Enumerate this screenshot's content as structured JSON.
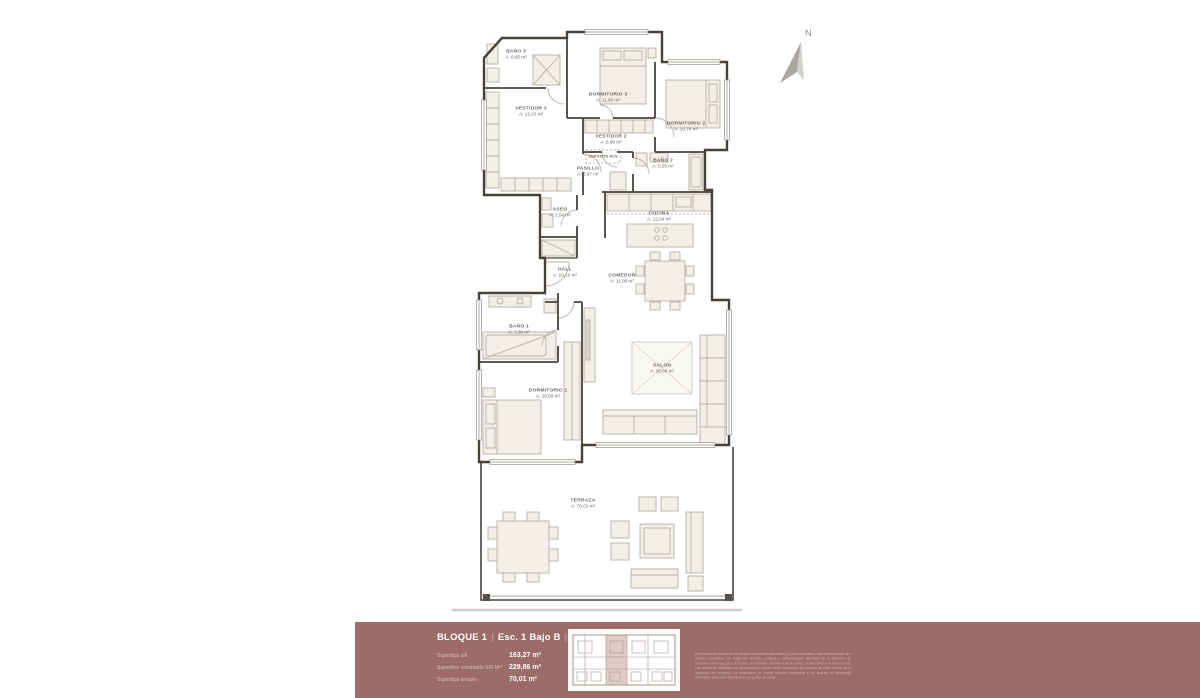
{
  "plan": {
    "north_label": "N",
    "rooms": [
      {
        "name": "BAÑO 3",
        "area": "A: 6,65 m²"
      },
      {
        "name": "DORMITORIO 3",
        "area": "A: 11,66 m²"
      },
      {
        "name": "VESTIDOR 3",
        "area": "A: 13,20 m²"
      },
      {
        "name": "DORMITORIO 2",
        "area": "A: 10,70 m²"
      },
      {
        "name": "VESTIDOR 2",
        "area": "A: 6,49 m²"
      },
      {
        "name": "DEPOSITO ACS",
        "area": ""
      },
      {
        "name": "PASILLO",
        "area": "A: 2,87 m²"
      },
      {
        "name": "BAÑO 2",
        "area": "A: 5,55 m²"
      },
      {
        "name": "ASEO",
        "area": "A: 2,54 m²"
      },
      {
        "name": "COCINA",
        "area": "A: 12,24 m²"
      },
      {
        "name": "HALL",
        "area": "A: 10,10 m²"
      },
      {
        "name": "COMEDOR",
        "area": "A: 11,09 m²"
      },
      {
        "name": "BAÑO 1",
        "area": "A: 7,39 m²"
      },
      {
        "name": "DORMITORIO 1",
        "area": "A: 20,58 m²"
      },
      {
        "name": "SALON",
        "area": "A: 38,68 m²"
      },
      {
        "name": "TERRAZA",
        "area": "A: 70,01 m²"
      }
    ]
  },
  "footer": {
    "block": "BLOQUE 1",
    "unit": "Esc. 1 Bajo B",
    "scale": "escala 1:75",
    "separator": "|",
    "specs": [
      {
        "label": "Superficie útil",
        "value": "163,27 m²"
      },
      {
        "label": "Superficie construida S/R M²*",
        "value": "229,86 m²"
      },
      {
        "label": "Superficie terraza",
        "value": "70,01 m²"
      }
    ],
    "disclaimer": "El presente documento es de carácter meramente informativo y queda supeditado a las modificaciones que resulten necesarias por exigencias técnicas, jurídicas o administrativas derivadas de la obtención de licencias y de la ejecución de la obra. El mobiliario, incluido el de la cocina, es decorativo y no está incluido. Las superficies indicadas son aproximadas y pueden sufrir variaciones por motivos de orden técnico en el desarrollo del proyecto. La información no reviste carácter contractual y se ajustará al documento informativo abreviado disponible en los puntos de venta."
  },
  "colors": {
    "footer_bg": "#9b6c68",
    "wall": "#474139",
    "highlight_unit": "#c79d99"
  }
}
